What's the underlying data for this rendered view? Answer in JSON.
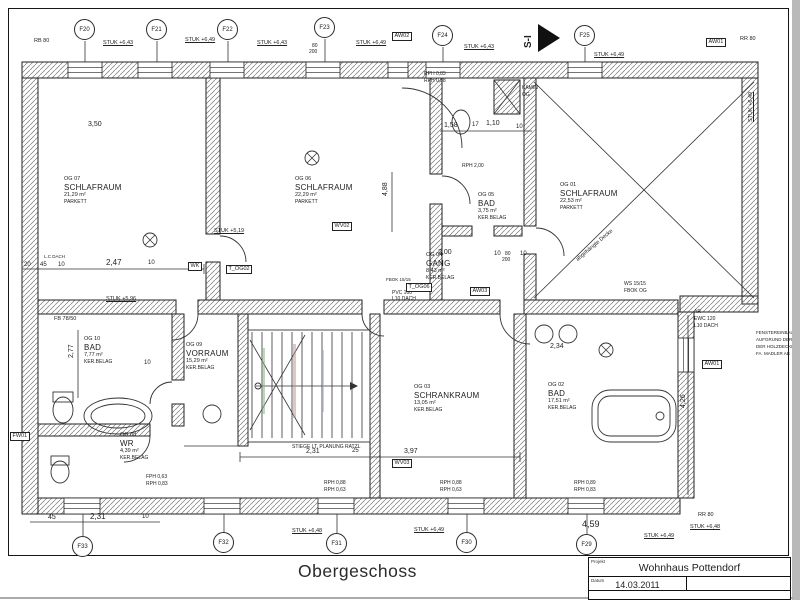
{
  "colors": {
    "ink": "#1d1d1d",
    "wall_hatch": "#777777",
    "scan_edge": "#b9b9b9",
    "stair_mark_green": "#8fae8f",
    "stair_mark_red": "#c09090",
    "stair_mark_blue": "#9aa4c0"
  },
  "footer": {
    "drawing_title": "Obergeschoss"
  },
  "title_block": {
    "project_label": "Projekt",
    "project_name": "Wohnhaus Pottendorf",
    "date_label": "Datum",
    "date_value": "14.03.2011"
  },
  "rooms": [
    {
      "id": "OG 07",
      "name": "SCHLAFRAUM",
      "area": "21,29 m²",
      "floor": "PARKETT",
      "x": 64,
      "y": 176
    },
    {
      "id": "OG 06",
      "name": "SCHLAFRAUM",
      "area": "22,29 m²",
      "floor": "PARKETT",
      "x": 295,
      "y": 176
    },
    {
      "id": "OG 05",
      "name": "BAD",
      "area": "3,75 m²",
      "floor": "KER.BELAG",
      "x": 478,
      "y": 192
    },
    {
      "id": "OG 01",
      "name": "SCHLAFRAUM",
      "area": "22,53 m²",
      "floor": "PARKETT",
      "x": 560,
      "y": 182
    },
    {
      "id": "OG 04",
      "name": "GANG",
      "area": "8,43 m²",
      "floor": "KER.BELAG",
      "x": 426,
      "y": 252
    },
    {
      "id": "OG 09",
      "name": "VORRAUM",
      "area": "15,29 m²",
      "floor": "KER.BELAG",
      "x": 186,
      "y": 342
    },
    {
      "id": "OG 10",
      "name": "BAD",
      "area": "7,77 m²",
      "floor": "KER.BELAG",
      "x": 84,
      "y": 336
    },
    {
      "id": "OG 08",
      "name": "WR",
      "area": "4,39 m²",
      "floor": "KER.BELAG",
      "x": 120,
      "y": 432
    },
    {
      "id": "OG 03",
      "name": "SCHRANKRAUM",
      "area": "13,05 m²",
      "floor": "KER.BELAG",
      "x": 414,
      "y": 384
    },
    {
      "id": "OG 02",
      "name": "BAD",
      "area": "17,51 m²",
      "floor": "KER.BELAG",
      "x": 548,
      "y": 382
    }
  ],
  "markers": [
    {
      "label": "F20",
      "x": 85,
      "y": 30
    },
    {
      "label": "F21",
      "x": 157,
      "y": 30
    },
    {
      "label": "F22",
      "x": 228,
      "y": 30
    },
    {
      "label": "F23",
      "x": 325,
      "y": 28
    },
    {
      "label": "F24",
      "x": 443,
      "y": 36
    },
    {
      "label": "F25",
      "x": 585,
      "y": 36
    },
    {
      "label": "F33",
      "x": 83,
      "y": 547
    },
    {
      "label": "F32",
      "x": 224,
      "y": 543
    },
    {
      "label": "F31",
      "x": 337,
      "y": 544
    },
    {
      "label": "F30",
      "x": 467,
      "y": 543
    },
    {
      "label": "F29",
      "x": 587,
      "y": 545
    }
  ],
  "tags": [
    {
      "t": "AW02",
      "x": 392,
      "y": 32
    },
    {
      "t": "AW01",
      "x": 706,
      "y": 38
    },
    {
      "t": "AW01",
      "x": 702,
      "y": 360
    },
    {
      "t": "FW01",
      "x": 10,
      "y": 432
    },
    {
      "t": "WK",
      "x": 188,
      "y": 262
    },
    {
      "t": "T_OG02",
      "x": 226,
      "y": 265
    },
    {
      "t": "WV02",
      "x": 332,
      "y": 222
    },
    {
      "t": "AW03",
      "x": 470,
      "y": 287
    },
    {
      "t": "WV03",
      "x": 392,
      "y": 459
    },
    {
      "t": "T_OG06",
      "x": 406,
      "y": 283
    }
  ],
  "stuk_labels": [
    {
      "t": "STUK +6,43",
      "x": 103,
      "y": 40,
      "s": 5.5
    },
    {
      "t": "STUK +6,49",
      "x": 185,
      "y": 37,
      "s": 5.5
    },
    {
      "t": "STUK +6,43",
      "x": 257,
      "y": 40,
      "s": 5.5
    },
    {
      "t": "STUK +6,49",
      "x": 356,
      "y": 40,
      "s": 5.5
    },
    {
      "t": "STUK +6,43",
      "x": 464,
      "y": 44,
      "s": 5.5
    },
    {
      "t": "STUK +6,49",
      "x": 594,
      "y": 52,
      "s": 5.5
    },
    {
      "t": "STUK +5,19",
      "x": 214,
      "y": 228,
      "s": 5.5
    },
    {
      "t": "STUK +5,96",
      "x": 106,
      "y": 296,
      "s": 5.5
    },
    {
      "t": "STUK +6,48",
      "x": 292,
      "y": 528,
      "s": 5.5
    },
    {
      "t": "STUK +6,49",
      "x": 414,
      "y": 527,
      "s": 5.5
    },
    {
      "t": "STUK +6,49",
      "x": 644,
      "y": 533,
      "s": 5.5
    },
    {
      "t": "STUK +6,48",
      "x": 690,
      "y": 524,
      "s": 5.5
    },
    {
      "t": "STUK +6,49",
      "x": 748,
      "y": 122,
      "s": 5.5,
      "r": -90
    }
  ],
  "rph_labels": [
    {
      "t": "RPH 0,83",
      "x": 424,
      "y": 72,
      "s": 5
    },
    {
      "t": "RPH 0,88",
      "x": 424,
      "y": 79,
      "s": 5
    },
    {
      "t": "RPH 2,00",
      "x": 462,
      "y": 164,
      "s": 5
    },
    {
      "t": "FPH 0,63",
      "x": 146,
      "y": 475,
      "s": 5
    },
    {
      "t": "RPH 0,83",
      "x": 146,
      "y": 482,
      "s": 5
    },
    {
      "t": "RPH 0,88",
      "x": 324,
      "y": 481,
      "s": 5
    },
    {
      "t": "RPH 0,63",
      "x": 324,
      "y": 488,
      "s": 5
    },
    {
      "t": "RPH 0,88",
      "x": 440,
      "y": 481,
      "s": 5
    },
    {
      "t": "RPH 0,63",
      "x": 440,
      "y": 488,
      "s": 5
    },
    {
      "t": "RPH 0,89",
      "x": 574,
      "y": 481,
      "s": 5
    },
    {
      "t": "RPH 0,83",
      "x": 574,
      "y": 488,
      "s": 5
    }
  ],
  "dims": [
    {
      "t": "3,50",
      "x": 88,
      "y": 121,
      "s": 7
    },
    {
      "t": "1,58",
      "x": 444,
      "y": 122,
      "s": 7
    },
    {
      "t": "17",
      "x": 472,
      "y": 122,
      "s": 6
    },
    {
      "t": "1,10",
      "x": 486,
      "y": 120,
      "s": 7
    },
    {
      "t": "10",
      "x": 516,
      "y": 124,
      "s": 6
    },
    {
      "t": "2,00",
      "x": 438,
      "y": 249,
      "s": 7
    },
    {
      "t": "10",
      "x": 494,
      "y": 251,
      "s": 6
    },
    {
      "t": "10",
      "x": 520,
      "y": 251,
      "s": 6
    },
    {
      "t": "4,88",
      "x": 382,
      "y": 196,
      "s": 7,
      "r": -90
    },
    {
      "t": "20",
      "x": 24,
      "y": 262,
      "s": 6
    },
    {
      "t": "45",
      "x": 40,
      "y": 262,
      "s": 6
    },
    {
      "t": "10",
      "x": 58,
      "y": 262,
      "s": 6
    },
    {
      "t": "2,47",
      "x": 106,
      "y": 259,
      "s": 8
    },
    {
      "t": "10",
      "x": 148,
      "y": 260,
      "s": 6
    },
    {
      "t": "2,77",
      "x": 68,
      "y": 358,
      "s": 7,
      "r": -90
    },
    {
      "t": "10",
      "x": 144,
      "y": 360,
      "s": 6
    },
    {
      "t": "45",
      "x": 48,
      "y": 514,
      "s": 7
    },
    {
      "t": "2,31",
      "x": 90,
      "y": 513,
      "s": 8
    },
    {
      "t": "10",
      "x": 142,
      "y": 514,
      "s": 6
    },
    {
      "t": "2,31",
      "x": 306,
      "y": 448,
      "s": 7
    },
    {
      "t": "25",
      "x": 352,
      "y": 448,
      "s": 6
    },
    {
      "t": "3,97",
      "x": 404,
      "y": 448,
      "s": 7
    },
    {
      "t": "2,34",
      "x": 550,
      "y": 343,
      "s": 7
    },
    {
      "t": "4,59",
      "x": 582,
      "y": 519,
      "s": 9
    },
    {
      "t": "4,26",
      "x": 680,
      "y": 408,
      "s": 7,
      "r": -90
    },
    {
      "t": "80",
      "x": 312,
      "y": 44,
      "s": 5
    },
    {
      "t": "200",
      "x": 309,
      "y": 50,
      "s": 5
    },
    {
      "t": "80",
      "x": 505,
      "y": 252,
      "s": 5
    },
    {
      "t": "200",
      "x": 502,
      "y": 258,
      "s": 5
    }
  ],
  "notes": [
    {
      "t": "RB 80",
      "x": 34,
      "y": 38,
      "s": 5.5
    },
    {
      "t": "RR 80",
      "x": 740,
      "y": 36,
      "s": 5.5
    },
    {
      "t": "RR 80",
      "x": 698,
      "y": 512,
      "s": 5.5
    },
    {
      "t": "KAMIN",
      "x": 522,
      "y": 86,
      "s": 5
    },
    {
      "t": "OG",
      "x": 522,
      "y": 93,
      "s": 5
    },
    {
      "t": "S-I",
      "x": 523,
      "y": 48,
      "s": 10,
      "r": -90,
      "b": 1
    },
    {
      "t": "STIEGE LT. PLANUNG RATZL",
      "x": 292,
      "y": 445,
      "s": 5
    },
    {
      "t": "abgehängte Decke",
      "x": 575,
      "y": 258,
      "s": 5.5,
      "r": -40
    },
    {
      "t": "AR",
      "x": 694,
      "y": 310,
      "s": 5
    },
    {
      "t": "EWC 120",
      "x": 694,
      "y": 317,
      "s": 5
    },
    {
      "t": "L10 DACH",
      "x": 694,
      "y": 324,
      "s": 5
    },
    {
      "t": "FENSTEREINBAU",
      "x": 756,
      "y": 330,
      "s": 4.5
    },
    {
      "t": "AUFGRUND DER",
      "x": 756,
      "y": 337,
      "s": 4.5
    },
    {
      "t": "DER HOLZDECKE",
      "x": 756,
      "y": 344,
      "s": 4.5
    },
    {
      "t": "FA. MADLER AB",
      "x": 756,
      "y": 351,
      "s": 4.5
    },
    {
      "t": "WS 15/15",
      "x": 624,
      "y": 282,
      "s": 5
    },
    {
      "t": "FBOK OG",
      "x": 624,
      "y": 289,
      "s": 5
    },
    {
      "t": "FBOK 15/15",
      "x": 386,
      "y": 277,
      "s": 4.5
    },
    {
      "t": "PVC 100",
      "x": 392,
      "y": 291,
      "s": 5
    },
    {
      "t": "L10 DACH",
      "x": 392,
      "y": 297,
      "s": 5
    },
    {
      "t": "L.C DACH",
      "x": 44,
      "y": 254,
      "s": 4.5
    },
    {
      "t": "FB 78/50",
      "x": 54,
      "y": 316,
      "s": 5.5
    }
  ],
  "plan": {
    "walls": [
      [
        22,
        62,
        736,
        16
      ],
      [
        22,
        78,
        16,
        436
      ],
      [
        38,
        498,
        642,
        16
      ],
      [
        742,
        78,
        16,
        226
      ],
      [
        680,
        296,
        78,
        16
      ],
      [
        678,
        312,
        16,
        186
      ],
      [
        38,
        300,
        138,
        14
      ],
      [
        198,
        300,
        164,
        14
      ],
      [
        384,
        300,
        116,
        14
      ],
      [
        524,
        300,
        154,
        14
      ],
      [
        206,
        78,
        14,
        156
      ],
      [
        206,
        262,
        14,
        38
      ],
      [
        430,
        78,
        12,
        96
      ],
      [
        430,
        204,
        12,
        96
      ],
      [
        442,
        226,
        30,
        10
      ],
      [
        494,
        226,
        28,
        10
      ],
      [
        524,
        78,
        12,
        148
      ],
      [
        524,
        254,
        12,
        46
      ],
      [
        172,
        314,
        12,
        66
      ],
      [
        172,
        404,
        12,
        22
      ],
      [
        38,
        424,
        112,
        12
      ],
      [
        238,
        314,
        10,
        132
      ],
      [
        370,
        314,
        10,
        184
      ],
      [
        514,
        314,
        12,
        184
      ],
      [
        494,
        80,
        26,
        34
      ]
    ],
    "windows": [
      [
        68,
        62,
        34,
        16
      ],
      [
        138,
        62,
        34,
        16
      ],
      [
        210,
        62,
        34,
        16
      ],
      [
        306,
        62,
        34,
        16
      ],
      [
        388,
        62,
        20,
        16
      ],
      [
        426,
        62,
        34,
        16
      ],
      [
        568,
        62,
        34,
        16
      ],
      [
        64,
        498,
        36,
        16
      ],
      [
        204,
        498,
        36,
        16
      ],
      [
        318,
        498,
        36,
        16
      ],
      [
        448,
        498,
        36,
        16
      ],
      [
        568,
        498,
        36,
        16
      ],
      [
        678,
        338,
        16,
        34
      ]
    ],
    "lines": [
      [
        85,
        41,
        85,
        62
      ],
      [
        157,
        41,
        157,
        62
      ],
      [
        228,
        41,
        228,
        62
      ],
      [
        325,
        39,
        325,
        62
      ],
      [
        443,
        47,
        443,
        62
      ],
      [
        585,
        47,
        585,
        62
      ],
      [
        83,
        536,
        83,
        514
      ],
      [
        224,
        532,
        224,
        514
      ],
      [
        337,
        533,
        337,
        514
      ],
      [
        467,
        532,
        467,
        514
      ],
      [
        587,
        534,
        587,
        514
      ],
      [
        252,
        332,
        252,
        438
      ],
      [
        262,
        332,
        262,
        438
      ],
      [
        272,
        332,
        272,
        438
      ],
      [
        282,
        332,
        282,
        438
      ],
      [
        292,
        332,
        292,
        438
      ],
      [
        302,
        332,
        302,
        438
      ],
      [
        312,
        332,
        312,
        438
      ],
      [
        322,
        332,
        322,
        438
      ],
      [
        332,
        332,
        332,
        438
      ],
      [
        342,
        332,
        342,
        438
      ],
      [
        352,
        332,
        352,
        438
      ],
      [
        362,
        332,
        362,
        438
      ],
      [
        250,
        430,
        305,
        335
      ],
      [
        250,
        340,
        305,
        435
      ],
      [
        256,
        386,
        350,
        386
      ],
      [
        534,
        82,
        754,
        298
      ],
      [
        754,
        82,
        534,
        298
      ],
      [
        494,
        80,
        520,
        114
      ],
      [
        520,
        80,
        494,
        114
      ],
      [
        22,
        269,
        204,
        269
      ],
      [
        30,
        522,
        160,
        522
      ],
      [
        240,
        457,
        520,
        457
      ],
      [
        440,
        131,
        532,
        131
      ],
      [
        688,
        315,
        688,
        495
      ],
      [
        78,
        330,
        78,
        398
      ],
      [
        392,
        172,
        392,
        232
      ],
      [
        22,
        264,
        22,
        274
      ],
      [
        204,
        264,
        204,
        274
      ],
      [
        240,
        452,
        240,
        462
      ],
      [
        520,
        452,
        520,
        462
      ],
      [
        184,
        446,
        238,
        446
      ],
      [
        145,
        235,
        155,
        245
      ],
      [
        145,
        245,
        155,
        235
      ],
      [
        307,
        153,
        317,
        163
      ],
      [
        307,
        163,
        317,
        153
      ],
      [
        601,
        345,
        611,
        355
      ],
      [
        601,
        355,
        611,
        345
      ]
    ],
    "paths": [
      "M198,314 A26,26 0 0 1 172,340",
      "M362,314 A22,22 0 0 0 384,336",
      "M500,314 A30,30 0 0 0 530,344",
      "M402,88 A60,60 0 0 1 462,148",
      "M442,176 A28,28 0 0 1 470,204",
      "M220,236 A26,26 0 0 1 246,262",
      "M536,228 A28,28 0 0 1 564,256",
      "M150,436 A26,26 0 0 1 124,462",
      "M172,382 A22,22 0 0 0 150,404"
    ],
    "circles": [
      [
        660,
        416,
        4
      ],
      [
        212,
        414,
        9
      ],
      [
        544,
        334,
        9
      ],
      [
        568,
        334,
        9
      ],
      [
        150,
        240,
        7
      ],
      [
        312,
        158,
        7
      ],
      [
        606,
        350,
        7
      ],
      [
        258,
        386,
        3
      ]
    ],
    "ellipses": [
      [
        118,
        416,
        34,
        18
      ],
      [
        118,
        416,
        27,
        12
      ],
      [
        63,
        410,
        10,
        13
      ],
      [
        60,
        472,
        9,
        11
      ],
      [
        461,
        122,
        9,
        12
      ]
    ],
    "rects": [
      {
        "x": 248,
        "y": 330,
        "w": 122,
        "h": 112
      },
      {
        "x": 592,
        "y": 390,
        "w": 84,
        "h": 52,
        "rx": 18
      },
      {
        "x": 598,
        "y": 396,
        "w": 72,
        "h": 40,
        "rx": 12
      },
      {
        "x": 53,
        "y": 392,
        "w": 20,
        "h": 10
      },
      {
        "x": 51,
        "y": 456,
        "w": 18,
        "h": 9
      },
      {
        "x": 262,
        "y": 348,
        "w": 3,
        "h": 66,
        "fill": "#8fae8f",
        "op": 0.55,
        "nostroke": 1
      },
      {
        "x": 293,
        "y": 344,
        "w": 3,
        "h": 74,
        "fill": "#c09090",
        "op": 0.5,
        "nostroke": 1
      },
      {
        "x": 322,
        "y": 350,
        "w": 2,
        "h": 62,
        "fill": "#9aa4c0",
        "op": 0.5,
        "nostroke": 1
      }
    ],
    "polys": [
      {
        "pts": "538,24 538,52 560,38",
        "fill": "#111"
      },
      {
        "pts": "350,382 350,390 358,386",
        "fill": "#333"
      }
    ]
  }
}
